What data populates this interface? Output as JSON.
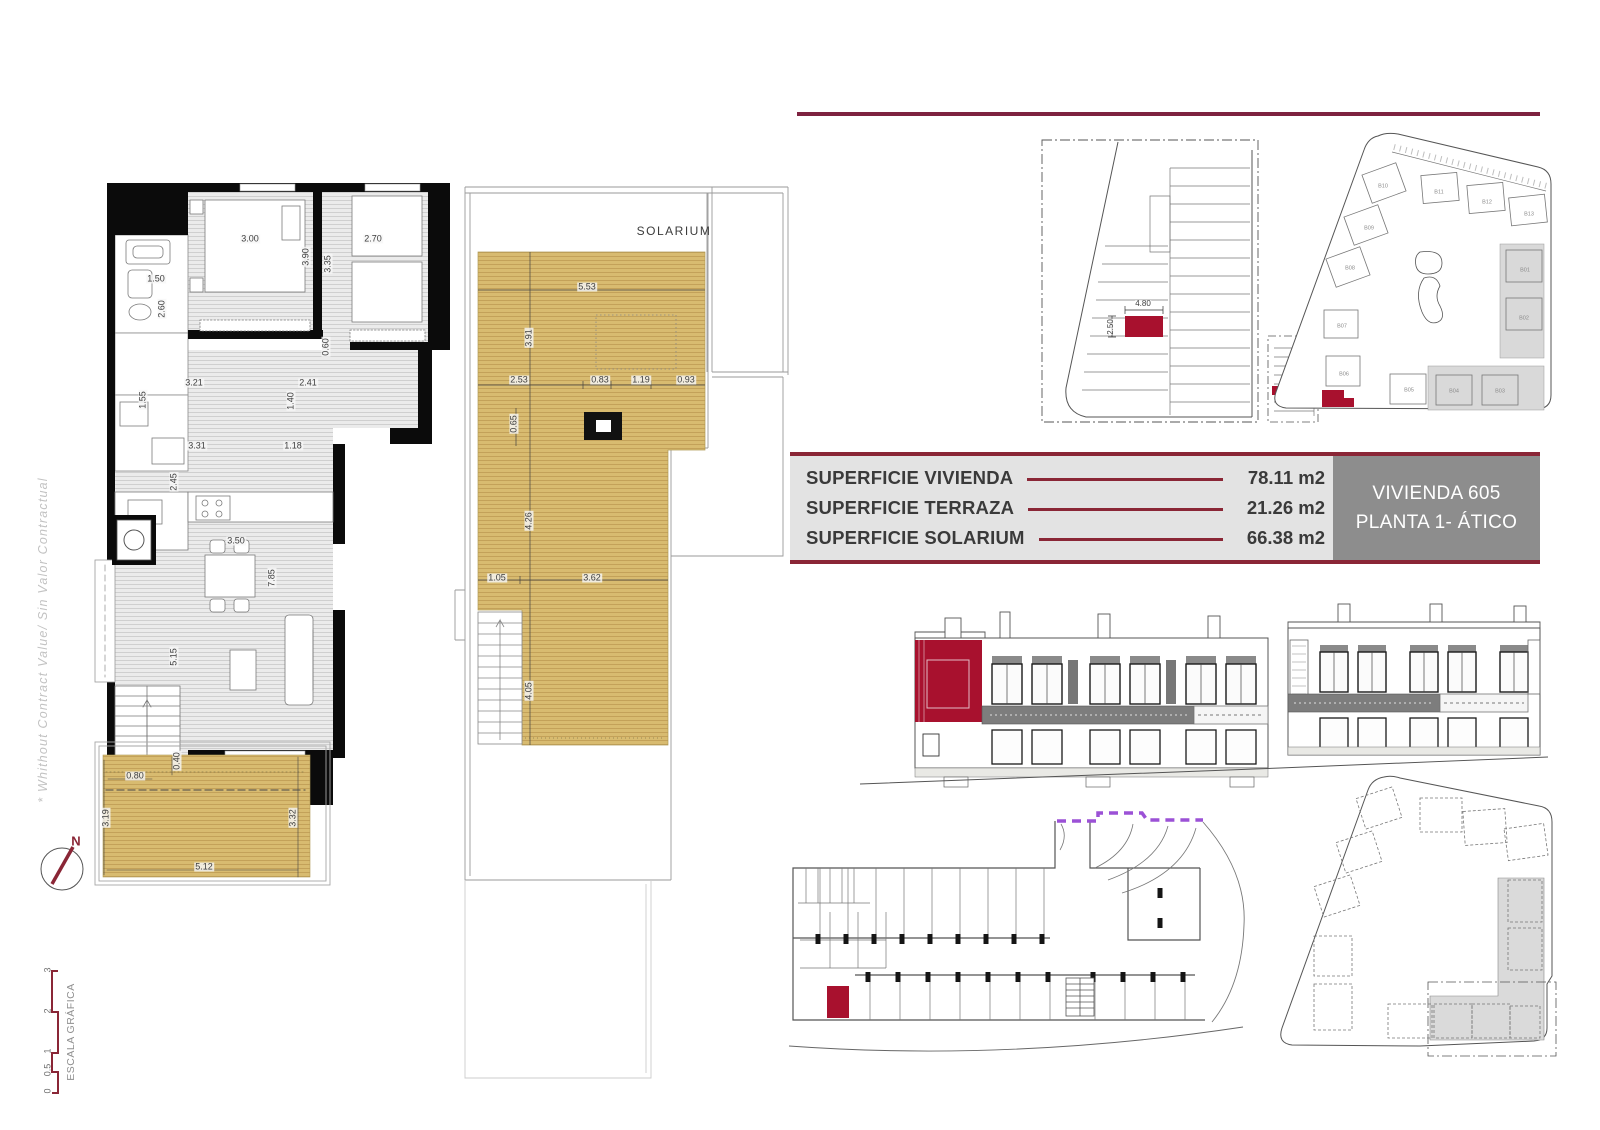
{
  "summary": {
    "rows": [
      {
        "label": "SUPERFICIE VIVIENDA",
        "value": "78.11 m2"
      },
      {
        "label": "SUPERFICIE TERRAZA",
        "value": "21.26 m2"
      },
      {
        "label": "SUPERFICIE SOLARIUM",
        "value": "66.38 m2"
      }
    ],
    "unit_box": {
      "line1": "VIVIENDA 605",
      "line2": "PLANTA 1- ÁTICO"
    }
  },
  "colors": {
    "accent_maroon": "#8A2636",
    "rule_maroon": "#7E2240",
    "highlight_red": "#A8112E",
    "deck_tan": "#D8BB70",
    "panel_gray": "#8D8D8D",
    "purple_dash": "#9B51D6"
  },
  "annotations": {
    "fp_dim": [
      {
        "t": "3.00",
        "x": 250,
        "y": 239
      },
      {
        "t": "3.90",
        "x": 306,
        "y": 257,
        "r": -90
      },
      {
        "t": "2.70",
        "x": 373,
        "y": 239
      },
      {
        "t": "3.35",
        "x": 328,
        "y": 264,
        "r": -90
      },
      {
        "t": "1.50",
        "x": 156,
        "y": 279
      },
      {
        "t": "2.60",
        "x": 162,
        "y": 309,
        "r": -90
      },
      {
        "t": "0.60",
        "x": 326,
        "y": 347,
        "r": -90
      },
      {
        "t": "3.21",
        "x": 194,
        "y": 383
      },
      {
        "t": "2.41",
        "x": 308,
        "y": 383
      },
      {
        "t": "1.55",
        "x": 143,
        "y": 400,
        "r": -90
      },
      {
        "t": "1.40",
        "x": 291,
        "y": 401,
        "r": -90
      },
      {
        "t": "3.31",
        "x": 197,
        "y": 446
      },
      {
        "t": "1.18",
        "x": 293,
        "y": 446
      },
      {
        "t": "2.45",
        "x": 174,
        "y": 482,
        "r": -90
      },
      {
        "t": "3.50",
        "x": 236,
        "y": 541
      },
      {
        "t": "7.85",
        "x": 272,
        "y": 578,
        "r": -90
      },
      {
        "t": "5.15",
        "x": 174,
        "y": 657,
        "r": -90
      },
      {
        "t": "0.80",
        "x": 135,
        "y": 776
      },
      {
        "t": "0.40",
        "x": 177,
        "y": 761,
        "r": -90
      },
      {
        "t": "3.19",
        "x": 106,
        "y": 818,
        "r": -90
      },
      {
        "t": "3.32",
        "x": 293,
        "y": 818,
        "r": -90
      },
      {
        "t": "5.12",
        "x": 204,
        "y": 867
      }
    ],
    "sol_title": [
      {
        "t": "SOLARIUM",
        "x": 674,
        "y": 231
      }
    ],
    "sol_dim": [
      {
        "t": "5.53",
        "x": 587,
        "y": 287
      },
      {
        "t": "3.91",
        "x": 529,
        "y": 338,
        "r": -90
      },
      {
        "t": "2.53",
        "x": 519,
        "y": 380
      },
      {
        "t": "0.83",
        "x": 600,
        "y": 380
      },
      {
        "t": "1.19",
        "x": 641,
        "y": 380
      },
      {
        "t": "0.93",
        "x": 686,
        "y": 380
      },
      {
        "t": "0.65",
        "x": 514,
        "y": 424,
        "r": -90
      },
      {
        "t": "4.26",
        "x": 529,
        "y": 521,
        "r": -90
      },
      {
        "t": "1.05",
        "x": 497,
        "y": 578
      },
      {
        "t": "3.62",
        "x": 592,
        "y": 578
      },
      {
        "t": "4.05",
        "x": 529,
        "y": 691,
        "r": -90
      }
    ],
    "park_dim": [
      {
        "t": "4.80",
        "x": 1143,
        "y": 304
      },
      {
        "t": "2.50",
        "x": 1111,
        "y": 327,
        "r": -90
      }
    ],
    "site_label": [
      {
        "t": "B10",
        "x": 1383,
        "y": 187
      },
      {
        "t": "B11",
        "x": 1439,
        "y": 193
      },
      {
        "t": "B12",
        "x": 1487,
        "y": 203
      },
      {
        "t": "B13",
        "x": 1529,
        "y": 215
      },
      {
        "t": "B09",
        "x": 1369,
        "y": 229
      },
      {
        "t": "B08",
        "x": 1350,
        "y": 269
      },
      {
        "t": "B07",
        "x": 1342,
        "y": 327
      },
      {
        "t": "B06",
        "x": 1344,
        "y": 375
      },
      {
        "t": "B05",
        "x": 1409,
        "y": 391
      },
      {
        "t": "B04",
        "x": 1454,
        "y": 392
      },
      {
        "t": "B03",
        "x": 1500,
        "y": 392
      },
      {
        "t": "B01",
        "x": 1525,
        "y": 271
      },
      {
        "t": "B02",
        "x": 1524,
        "y": 319
      }
    ],
    "scale_tick": [
      {
        "t": "0",
        "x": 48,
        "y": 1091,
        "r": -90
      },
      {
        "t": "0.5",
        "x": 48,
        "y": 1070,
        "r": -90
      },
      {
        "t": "1",
        "x": 48,
        "y": 1051,
        "r": -90
      },
      {
        "t": "2",
        "x": 48,
        "y": 1011,
        "r": -90
      },
      {
        "t": "3",
        "x": 48,
        "y": 970,
        "r": -90
      }
    ],
    "scale_title": [
      {
        "t": "ESCALA GRÁFICA",
        "x": 71,
        "y": 1032,
        "r": -90
      }
    ],
    "north_label": [
      {
        "t": "N",
        "x": 76,
        "y": 841
      }
    ],
    "disclaimer": [
      {
        "t": "* Whithout Contract Value/ Sin Valor Contractual",
        "x": 43,
        "y": 640,
        "r": -90
      }
    ]
  }
}
